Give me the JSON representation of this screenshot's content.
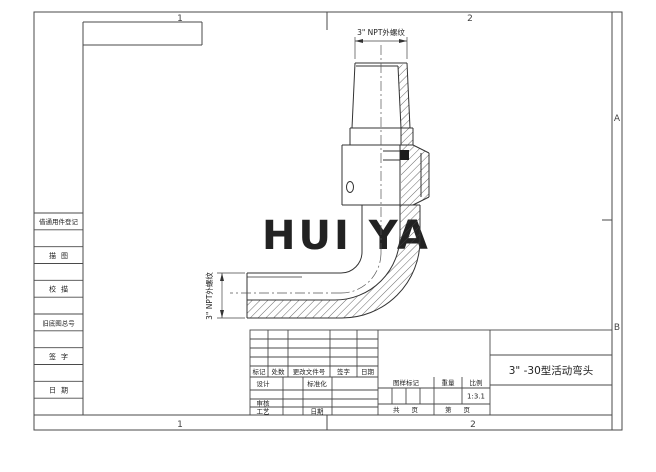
{
  "zones": {
    "top_left": "1",
    "top_right": "2",
    "bottom_left": "1",
    "bottom_right": "2",
    "right_upper": "A",
    "right_lower": "B"
  },
  "left_strip": {
    "labels": [
      "借通用件登记",
      "描图",
      "校描",
      "旧底图总号",
      "签字",
      "日期"
    ]
  },
  "watermark": {
    "text": "HUI YA",
    "color": "#ef8585"
  },
  "drawing": {
    "top_thread_label": "3\" NPT外螺纹",
    "side_thread_label": "3\" NPT外螺纹"
  },
  "title_block": {
    "revision_headers": [
      "标记",
      "处数",
      "更改文件号",
      "签字",
      "日期"
    ],
    "design_label": "设计",
    "standard_label": "标准化",
    "check_label": "审核",
    "process_label": "工艺",
    "date_label": "日期",
    "drawing_mark_label": "图样标记",
    "weight_label": "重量",
    "scale_label": "比例",
    "scale_value": "1:3.1",
    "total_sheets_label": "共 页",
    "sheet_no_label": "第 页",
    "title": "3\" -30型活动弯头"
  }
}
